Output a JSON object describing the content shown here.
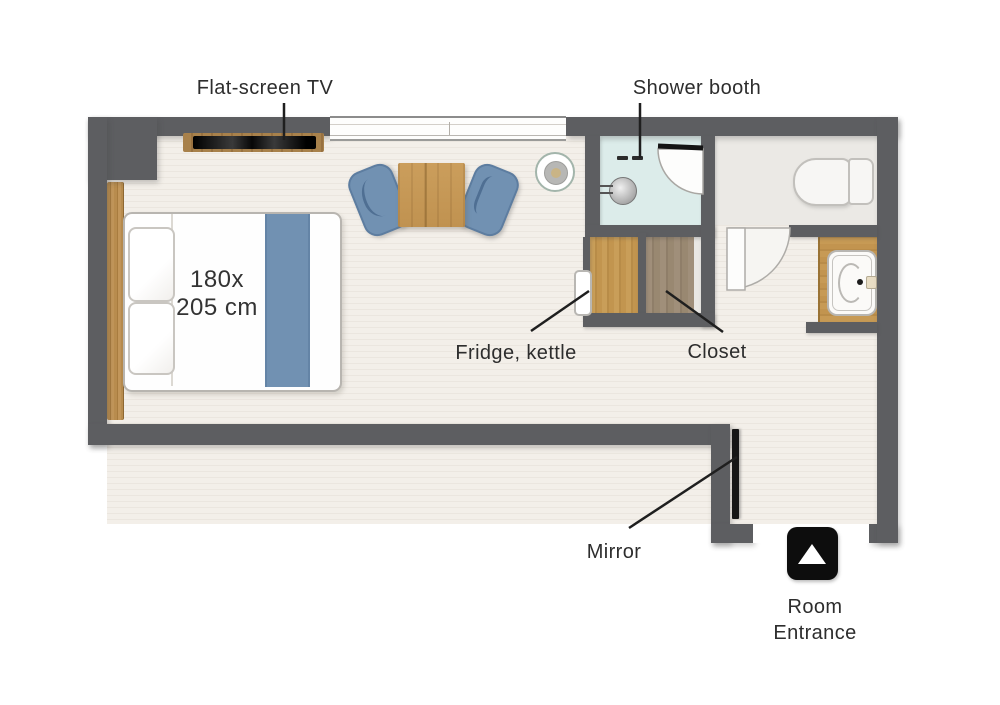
{
  "title": "Hotel room floor plan",
  "labels": {
    "tv": "Flat-screen TV",
    "shower": "Shower booth",
    "fridge": "Fridge, kettle",
    "closet": "Closet",
    "mirror": "Mirror",
    "entrance_line1": "Room",
    "entrance_line2": "Entrance"
  },
  "bed": {
    "size_line1": "180x",
    "size_line2": "205 cm"
  },
  "colors": {
    "wall": "#5d5e61",
    "floor": "#f2eee8",
    "shower_floor": "#dcecea",
    "toilet_floor": "#ebe9e5",
    "accent_blue": "#7191b2",
    "wood_light": "#c0914f",
    "wood_dark": "#998871",
    "label_text": "#2d2d2d",
    "entrance_marker": "#0d0d0d"
  },
  "icons": {
    "entrance_arrow": "up-triangle"
  }
}
